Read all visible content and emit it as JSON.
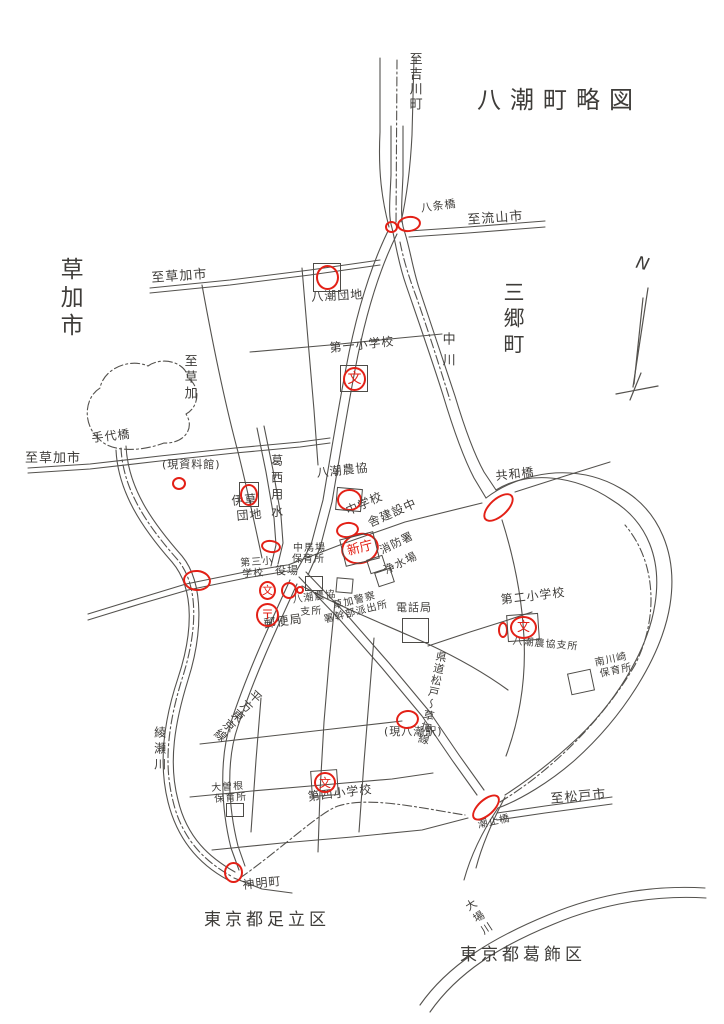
{
  "title": "八潮町略図",
  "compass": {
    "label": "N"
  },
  "colors": {
    "ink": "#4d4b47",
    "red": "#e32016",
    "paper": "#ffffff"
  },
  "labels": [
    {
      "name": "to-yoshikawa-cho-label",
      "t": "至吉川町",
      "x": 407,
      "y": 52,
      "s": 13,
      "o": "v",
      "ls": 2
    },
    {
      "name": "hachijo-bridge-label",
      "t": "八条橋",
      "x": 420,
      "y": 203,
      "s": 11,
      "o": "h",
      "r": -8
    },
    {
      "name": "to-nagareyama-city-label",
      "t": "至流山市",
      "x": 467,
      "y": 214,
      "s": 13,
      "o": "h",
      "r": -4
    },
    {
      "name": "soka-city-label",
      "t": "草加市",
      "x": 57,
      "y": 257,
      "s": 23,
      "o": "v",
      "ls": 5
    },
    {
      "name": "misato-town-label",
      "t": "三郷町",
      "x": 502,
      "y": 281,
      "s": 21,
      "o": "v",
      "ls": 5
    },
    {
      "name": "to-soka-city-top-label",
      "t": "至草加市",
      "x": 151,
      "y": 272,
      "s": 13,
      "o": "h",
      "r": -4
    },
    {
      "name": "yashio-danchi-label",
      "t": "八潮団地",
      "x": 311,
      "y": 291,
      "s": 12,
      "o": "h",
      "r": -3
    },
    {
      "name": "nakagawa-river-label",
      "t": "中川",
      "x": 440,
      "y": 332,
      "s": 13,
      "o": "v",
      "ls": 8
    },
    {
      "name": "dai1-elementary-label",
      "t": "第一小学校",
      "x": 329,
      "y": 342,
      "s": 12,
      "o": "h",
      "r": -6
    },
    {
      "name": "to-soka-label",
      "t": "至草加",
      "x": 182,
      "y": 354,
      "s": 13,
      "o": "v",
      "ls": 3
    },
    {
      "name": "teshiro-bridge-label",
      "t": "手代橋",
      "x": 91,
      "y": 432,
      "s": 12,
      "o": "h",
      "r": -6
    },
    {
      "name": "to-soka-city-left-label",
      "t": "至草加市",
      "x": 25,
      "y": 452,
      "s": 13,
      "o": "h"
    },
    {
      "name": "former-museum-label",
      "t": "(現資料館)",
      "x": 162,
      "y": 459,
      "s": 11,
      "o": "h"
    },
    {
      "name": "kasai-canal-label",
      "t": "葛西用水",
      "x": 270,
      "y": 454,
      "s": 12,
      "o": "v",
      "ls": 5
    },
    {
      "name": "yashio-nokyo-label",
      "t": "八潮農協",
      "x": 316,
      "y": 467,
      "s": 12,
      "o": "h",
      "r": -6
    },
    {
      "name": "igusa-danchi-label-1",
      "t": "伊草",
      "x": 231,
      "y": 495,
      "s": 12,
      "o": "h",
      "r": -5
    },
    {
      "name": "igusa-danchi-label-2",
      "t": "団地",
      "x": 236,
      "y": 510,
      "s": 12,
      "o": "h",
      "r": -5
    },
    {
      "name": "junior-high-label",
      "t": "中学校",
      "x": 344,
      "y": 506,
      "s": 12,
      "o": "h",
      "r": -24
    },
    {
      "name": "new-hall-construction-label",
      "t": "舎建設中",
      "x": 366,
      "y": 518,
      "s": 12,
      "o": "h",
      "r": -24
    },
    {
      "name": "fire-station-label",
      "t": "消防署",
      "x": 378,
      "y": 546,
      "s": 11,
      "o": "h",
      "r": -26
    },
    {
      "name": "water-plant-label",
      "t": "浄水場",
      "x": 382,
      "y": 566,
      "s": 11,
      "o": "h",
      "r": -26
    },
    {
      "name": "nakababa-nursery-label-1",
      "t": "中馬場",
      "x": 293,
      "y": 544,
      "s": 10,
      "o": "h"
    },
    {
      "name": "nakababa-nursery-label-2",
      "t": "保育所",
      "x": 292,
      "y": 555,
      "s": 10,
      "o": "h"
    },
    {
      "name": "town-office-label",
      "t": "役場",
      "x": 275,
      "y": 565,
      "s": 11,
      "o": "h"
    },
    {
      "name": "dai3-elementary-label-1",
      "t": "第三小",
      "x": 240,
      "y": 559,
      "s": 10,
      "o": "h",
      "r": -4
    },
    {
      "name": "dai3-elementary-label-2",
      "t": "学校",
      "x": 242,
      "y": 570,
      "s": 10,
      "o": "h",
      "r": -4
    },
    {
      "name": "post-office-label",
      "t": "郵便局",
      "x": 263,
      "y": 618,
      "s": 12,
      "o": "h",
      "r": -8
    },
    {
      "name": "nokyo-branch-label-1",
      "t": "八潮農協",
      "x": 292,
      "y": 596,
      "s": 10,
      "o": "h",
      "r": -8
    },
    {
      "name": "nokyo-branch-label-2",
      "t": "支所",
      "x": 300,
      "y": 608,
      "s": 10,
      "o": "h",
      "r": -4
    },
    {
      "name": "soka-police-label-1",
      "t": "草加警察",
      "x": 332,
      "y": 602,
      "s": 10,
      "o": "h",
      "r": -14
    },
    {
      "name": "soka-police-label-2",
      "t": "署幹部派出所",
      "x": 323,
      "y": 616,
      "s": 10,
      "o": "h",
      "r": -14
    },
    {
      "name": "telephone-office-label",
      "t": "電話局",
      "x": 396,
      "y": 602,
      "s": 11,
      "o": "h"
    },
    {
      "name": "dai2-elementary-label",
      "t": "第二小学校",
      "x": 500,
      "y": 594,
      "s": 12,
      "o": "h",
      "r": -7
    },
    {
      "name": "nokyo-branch2-label",
      "t": "八潮農協支所",
      "x": 513,
      "y": 637,
      "s": 10,
      "o": "h",
      "r": 5
    },
    {
      "name": "minamikawasaki-nursery-label-1",
      "t": "南川崎",
      "x": 594,
      "y": 659,
      "s": 10,
      "o": "h",
      "r": -12
    },
    {
      "name": "minamikawasaki-nursery-label-2",
      "t": "保育所",
      "x": 599,
      "y": 670,
      "s": 10,
      "o": "h",
      "r": -12
    },
    {
      "name": "kyowa-bridge-label",
      "t": "共和橋",
      "x": 495,
      "y": 470,
      "s": 12,
      "o": "h",
      "r": -6
    },
    {
      "name": "kendo-matsudo-soka-label",
      "t": "県道松戸～草加線",
      "x": 426,
      "y": 650,
      "s": 11,
      "o": "v",
      "r": 12,
      "ls": 1
    },
    {
      "name": "yashio-station-label",
      "t": "(現八潮駅)",
      "x": 384,
      "y": 726,
      "s": 11,
      "o": "h"
    },
    {
      "name": "hirakata-tokyo-line-label",
      "t": "平方東京線",
      "x": 231,
      "y": 683,
      "s": 12,
      "o": "v",
      "r": 42,
      "ls": 1
    },
    {
      "name": "ayase-river-label",
      "t": "綾瀬川",
      "x": 153,
      "y": 726,
      "s": 12,
      "o": "v",
      "ls": 4
    },
    {
      "name": "osone-nursery-label-1",
      "t": "大曽根",
      "x": 211,
      "y": 784,
      "s": 10,
      "o": "h",
      "r": -4
    },
    {
      "name": "osone-nursery-label-2",
      "t": "保育所",
      "x": 214,
      "y": 795,
      "s": 10,
      "o": "h",
      "r": -4
    },
    {
      "name": "dai4-elementary-label",
      "t": "第四小学校",
      "x": 307,
      "y": 791,
      "s": 12,
      "o": "h",
      "r": -7
    },
    {
      "name": "shinmei-cho-label",
      "t": "神明町",
      "x": 242,
      "y": 879,
      "s": 12,
      "o": "h",
      "r": -6
    },
    {
      "name": "tokyo-adachi-ward-label",
      "t": "東京都足立区",
      "x": 204,
      "y": 912,
      "s": 17,
      "o": "h",
      "ls": 4
    },
    {
      "name": "to-matsudo-city-label",
      "t": "至松戸市",
      "x": 550,
      "y": 793,
      "s": 13,
      "o": "h",
      "r": -5
    },
    {
      "name": "shiodome-bridge-label",
      "t": "潮止橋",
      "x": 477,
      "y": 821,
      "s": 10,
      "o": "h",
      "r": -12
    },
    {
      "name": "obagawa-river-label",
      "t": "大場川",
      "x": 473,
      "y": 897,
      "s": 11,
      "o": "v",
      "r": -33,
      "ls": 3
    },
    {
      "name": "tokyo-katsushika-ward-label",
      "t": "東京都葛飾区",
      "x": 460,
      "y": 947,
      "s": 17,
      "o": "h",
      "ls": 4
    }
  ],
  "markers": [
    {
      "name": "marker-hachijo-bridge-a",
      "x": 385,
      "y": 221,
      "w": 13,
      "h": 12
    },
    {
      "name": "marker-hachijo-bridge-b",
      "x": 397,
      "y": 216,
      "w": 24,
      "h": 16,
      "r": -8
    },
    {
      "name": "marker-yashio-danchi",
      "x": 316,
      "y": 265,
      "w": 23,
      "h": 25
    },
    {
      "name": "marker-dai1-school",
      "x": 343,
      "y": 367,
      "w": 23,
      "h": 24,
      "t": "文",
      "ts": 14
    },
    {
      "name": "marker-former-museum",
      "x": 172,
      "y": 477,
      "w": 14,
      "h": 13
    },
    {
      "name": "marker-igusa-danchi",
      "x": 240,
      "y": 484,
      "w": 18,
      "h": 22
    },
    {
      "name": "marker-yashio-nokyo",
      "x": 337,
      "y": 489,
      "w": 25,
      "h": 22
    },
    {
      "name": "marker-junior-high",
      "x": 336,
      "y": 522,
      "w": 23,
      "h": 16,
      "r": -8
    },
    {
      "name": "marker-new-hall",
      "x": 341,
      "y": 533,
      "w": 38,
      "h": 31,
      "r": -15,
      "t": "新庁",
      "ts": 13
    },
    {
      "name": "marker-kasai-crossing",
      "x": 261,
      "y": 540,
      "w": 20,
      "h": 13,
      "r": 8
    },
    {
      "name": "marker-yanaginomiya-bridge",
      "x": 183,
      "y": 570,
      "w": 28,
      "h": 21,
      "r": 5
    },
    {
      "name": "marker-dai3-school",
      "x": 259,
      "y": 581,
      "w": 17,
      "h": 19,
      "t": "文",
      "ts": 11
    },
    {
      "name": "marker-town-office",
      "x": 281,
      "y": 582,
      "w": 16,
      "h": 17
    },
    {
      "name": "marker-town-office-dot",
      "x": 296,
      "y": 586,
      "w": 8,
      "h": 8
    },
    {
      "name": "marker-post-office",
      "x": 256,
      "y": 603,
      "w": 23,
      "h": 24,
      "t": "〒",
      "ts": 13
    },
    {
      "name": "marker-kyowa-bridge",
      "x": 480,
      "y": 498,
      "w": 37,
      "h": 19,
      "r": -42
    },
    {
      "name": "marker-dai2-school",
      "x": 510,
      "y": 616,
      "w": 27,
      "h": 23,
      "t": "文",
      "ts": 13
    },
    {
      "name": "marker-dai2-school-small",
      "x": 498,
      "y": 622,
      "w": 10,
      "h": 16
    },
    {
      "name": "marker-yashio-station",
      "x": 396,
      "y": 710,
      "w": 23,
      "h": 19,
      "r": -8
    },
    {
      "name": "marker-dai4-school",
      "x": 314,
      "y": 772,
      "w": 22,
      "h": 21,
      "t": "文",
      "ts": 12
    },
    {
      "name": "marker-shinmei-cho",
      "x": 224,
      "y": 862,
      "w": 19,
      "h": 21
    },
    {
      "name": "marker-shiodome-bridge",
      "x": 469,
      "y": 799,
      "w": 34,
      "h": 17,
      "r": -42
    }
  ],
  "squares": [
    {
      "x": 313,
      "y": 263,
      "w": 28,
      "h": 29
    },
    {
      "x": 340,
      "y": 365,
      "w": 28,
      "h": 27
    },
    {
      "x": 239,
      "y": 482,
      "w": 20,
      "h": 25
    },
    {
      "x": 336,
      "y": 488,
      "w": 26,
      "h": 23,
      "r": 5
    },
    {
      "x": 342,
      "y": 535,
      "w": 35,
      "h": 28,
      "r": -14
    },
    {
      "x": 368,
      "y": 557,
      "w": 17,
      "h": 15,
      "r": -18
    },
    {
      "x": 376,
      "y": 570,
      "w": 17,
      "h": 15,
      "r": -18
    },
    {
      "x": 305,
      "y": 576,
      "w": 18,
      "h": 15
    },
    {
      "x": 336,
      "y": 578,
      "w": 17,
      "h": 15,
      "r": 5
    },
    {
      "x": 402,
      "y": 618,
      "w": 27,
      "h": 25
    },
    {
      "x": 507,
      "y": 614,
      "w": 32,
      "h": 27,
      "r": -4
    },
    {
      "x": 569,
      "y": 671,
      "w": 24,
      "h": 22,
      "r": -12
    },
    {
      "x": 226,
      "y": 803,
      "w": 18,
      "h": 14
    },
    {
      "x": 311,
      "y": 770,
      "w": 27,
      "h": 26,
      "r": -4
    }
  ]
}
